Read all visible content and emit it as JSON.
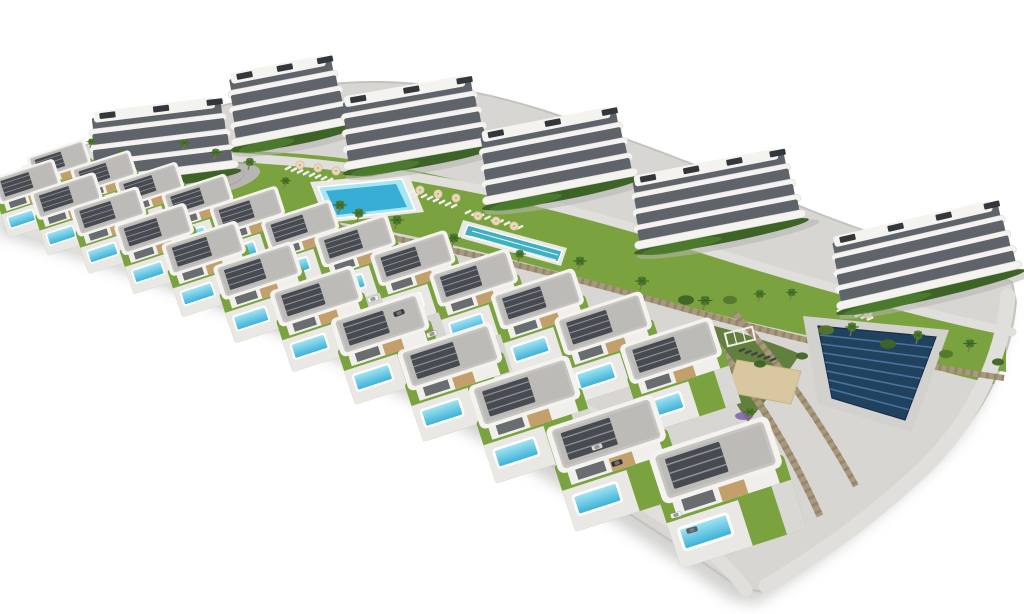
{
  "meta": {
    "type": "architectural-aerial-render",
    "aria_label": "Aerial 3D rendering of a hillside residential development: six white apartment buildings with wavy balconies at the back, two communal pools with sun loungers and palm trees, rows of modern villas with private turquoise pools in front, stone retaining walls, lawns with lavender, a solar panel field and a sand court on the right"
  },
  "palette": {
    "background": "#ffffff",
    "platform": "#d7d6d3",
    "platform_edge": "#c3c2bf",
    "shadow": "#a5a4a1",
    "road": "#e0dfdc",
    "road_mid": "#d0cfcc",
    "lawn": "#7aa340",
    "lawn_dark": "#55762c",
    "hedge": "#3e6327",
    "wall_stone": "#a8997d",
    "wall_stone_dark": "#85775c",
    "building_white": "#f4f3f0",
    "building_recess": "#5f646a",
    "pergola_dark": "#33373c",
    "roof_fascia": "#f4f3f0",
    "roof_gray": "#c6c5c1",
    "roof_gravel": "#bcbbb7",
    "roof_solar": "#474a50",
    "roof_solar_line": "#8e9196",
    "facade": "#f0efeb",
    "facade_wood": "#c3a06b",
    "window_dark": "#3c4147",
    "pool_light": "#a7e7f4",
    "pool_deep": "#37aed6",
    "pool_rim": "#ffffff",
    "deck": "#e9e8e4",
    "lap_pool": "#3fb0bf",
    "solar_panel": "#21425f",
    "solar_stripe": "#47749e",
    "solar_pad": "#d2d1ce",
    "sand": "#d9c7a0",
    "lavender": "#7e62ab",
    "palm_green": "#4e7c2f",
    "palm_dark": "#3c6322",
    "palm_trunk": "#8a6f4e",
    "lounger_white": "#f3f2ef",
    "lounger_dark": "#3f444a",
    "parasol": "#ead9b8",
    "car_light": "#f2f2f0",
    "plaza": "#b8b6b2"
  },
  "platform": {
    "outline": "M 6,196 C 30,168 62,150 122,134 C 200,112 262,92 332,84 C 402,77 472,88 542,110 C 622,136 722,175 822,215 C 902,246 982,268 1012,282 L 1016,302 C 1010,362 984,416 934,462 C 878,514 820,558 764,592 L 740,588 C 640,518 480,416 330,342 C 218,288 96,246 6,222 Z",
    "shadow_dx": -8,
    "shadow_dy": 12
  },
  "greens": {
    "amenity": "M 58,162 C 160,148 280,146 380,164 C 480,182 580,212 690,248 C 800,284 918,316 1006,334 L 1006,372 C 900,356 780,332 670,302 C 560,272 460,244 360,226 C 260,208 150,196 54,186 Z",
    "right": "M 836,300 C 898,318 958,330 1002,336 L 994,384 C 938,372 878,352 834,336 Z",
    "slope": "M 698,322 C 740,332 772,342 800,354 C 782,382 764,402 748,422 C 726,390 710,356 698,322 Z"
  },
  "roads": [
    {
      "name": "promenade-top",
      "d": "M 60,156 C 300,148 480,178 700,248 C 832,290 950,320 1012,332",
      "width": 9
    },
    {
      "name": "street-middle",
      "d": "M 22,204 C 250,262 480,356 640,436 C 700,466 730,488 758,512",
      "width": 11
    },
    {
      "name": "street-front",
      "d": "M 8,222 C 240,300 470,408 640,502 C 692,534 722,558 746,590",
      "width": 13
    },
    {
      "name": "road-right-edge",
      "d": "M 1008,296 C 1002,360 972,420 926,466 C 878,512 824,552 766,586",
      "width": 15
    }
  ],
  "walls": [
    {
      "d": "M 54,186 C 260,208 460,246 660,302 C 800,342 920,366 1004,378",
      "width": 6
    },
    {
      "d": "M 698,322 C 748,380 788,444 820,516",
      "width": 7
    },
    {
      "d": "M 734,312 C 782,366 822,424 856,486",
      "width": 6
    }
  ],
  "buildings": [
    {
      "x": 160,
      "y": 141,
      "w": 138,
      "floors": 4,
      "rot": -7
    },
    {
      "x": 286,
      "y": 100,
      "w": 112,
      "floors": 4,
      "rot": -11
    },
    {
      "x": 412,
      "y": 122,
      "w": 138,
      "floors": 4,
      "rot": -10
    },
    {
      "x": 554,
      "y": 155,
      "w": 146,
      "floors": 4,
      "rot": -11
    },
    {
      "x": 714,
      "y": 198,
      "w": 162,
      "floors": 4,
      "rot": -11
    },
    {
      "x": 922,
      "y": 254,
      "w": 178,
      "floors": 4,
      "rot": -13
    }
  ],
  "villas": {
    "rows": [
      {
        "name": "villa-row-back",
        "positions": [
          [
            62,
            170,
            0.72
          ],
          [
            107,
            182,
            0.75
          ],
          [
            153,
            195,
            0.78
          ],
          [
            201,
            208,
            0.81
          ],
          [
            251,
            222,
            0.85
          ],
          [
            304,
            237,
            0.88
          ],
          [
            359,
            253,
            0.92
          ],
          [
            417,
            271,
            0.96
          ],
          [
            478,
            291,
            1.0
          ],
          [
            542,
            313,
            1.05
          ],
          [
            608,
            338,
            1.1
          ],
          [
            676,
            366,
            1.15
          ]
        ]
      },
      {
        "name": "villa-row-front",
        "positions": [
          [
            30,
            192,
            0.78
          ],
          [
            70,
            207,
            0.82
          ],
          [
            112,
            223,
            0.86
          ],
          [
            158,
            241,
            0.9
          ],
          [
            208,
            261,
            0.95
          ],
          [
            262,
            284,
            1.0
          ],
          [
            321,
            310,
            1.05
          ],
          [
            385,
            339,
            1.11
          ],
          [
            455,
            372,
            1.18
          ],
          [
            530,
            409,
            1.26
          ],
          [
            612,
            452,
            1.35
          ],
          [
            722,
            480,
            1.5
          ]
        ]
      }
    ]
  },
  "pools": {
    "main": {
      "deck": "310,182 408,173 424,212 326,223",
      "water": "318,187 402,179 415,210 331,219",
      "core": "326,191 396,184 407,207 337,215"
    },
    "lap": {
      "deck": "463,220 567,248 561,266 457,237",
      "water": "468,225 562,251 558,262 464,235",
      "lanes": [
        {
          "x1": 472,
          "y1": 231,
          "x2": 558,
          "y2": 255
        },
        {
          "x1": 470,
          "y1": 236,
          "x2": 556,
          "y2": 260
        }
      ]
    }
  },
  "features": {
    "playground": {
      "cx": 215,
      "cy": 180,
      "rx": 46,
      "ry": 14,
      "rot": -12,
      "dots": [
        [
          200,
          176,
          "#cf9a3c"
        ],
        [
          214,
          183,
          "#5a87c5"
        ],
        [
          228,
          178,
          "#c96b4a"
        ],
        [
          220,
          174,
          "#7aa340"
        ]
      ]
    },
    "sand_court": {
      "points": "737,360 801,371 791,404 727,392"
    },
    "solar": {
      "pad": "803,316 949,330 912,432 818,404",
      "panels": "818,326 936,337 905,420 832,398",
      "stripes": 7
    },
    "pergola": {
      "x": 726,
      "y": 330,
      "w": 28,
      "h": 13,
      "rot": -14
    },
    "clubhouse": {
      "x": 52,
      "y": 172,
      "rot": -15
    }
  },
  "loungers": [
    {
      "x": 288,
      "y": 168,
      "n": 8,
      "dx": 6,
      "dy": 1.7,
      "rot": -28,
      "dark": false
    },
    {
      "x": 412,
      "y": 192,
      "n": 8,
      "dx": 6,
      "dy": 2.0,
      "rot": -28,
      "dark": false
    },
    {
      "x": 468,
      "y": 212,
      "n": 9,
      "dx": 6.5,
      "dy": 1.9,
      "rot": -26,
      "dark": false
    },
    {
      "x": 840,
      "y": 310,
      "n": 6,
      "dx": 6,
      "dy": 1.7,
      "rot": -24,
      "dark": false
    },
    {
      "x": 742,
      "y": 350,
      "n": 6,
      "dx": 6.2,
      "dy": 1.9,
      "rot": -22,
      "dark": true
    }
  ],
  "parasols": [
    [
      300,
      165
    ],
    [
      318,
      168
    ],
    [
      336,
      171
    ],
    [
      420,
      190
    ],
    [
      438,
      194
    ],
    [
      456,
      198
    ],
    [
      478,
      216
    ],
    [
      496,
      221
    ],
    [
      514,
      226
    ],
    [
      852,
      310
    ],
    [
      868,
      314
    ]
  ],
  "palms": [
    [
      183,
      150,
      0.8
    ],
    [
      214,
      160,
      0.85
    ],
    [
      248,
      170,
      0.9
    ],
    [
      338,
      214,
      1
    ],
    [
      357,
      222,
      1
    ],
    [
      395,
      229,
      1
    ],
    [
      452,
      247,
      1
    ],
    [
      518,
      262,
      0.9
    ],
    [
      578,
      270,
      1
    ],
    [
      640,
      290,
      1
    ],
    [
      703,
      310,
      1.05
    ],
    [
      758,
      302,
      0.9
    ],
    [
      850,
      336,
      1
    ],
    [
      916,
      344,
      1
    ],
    [
      968,
      352,
      0.95
    ],
    [
      120,
      160,
      0.75
    ],
    [
      90,
      148,
      0.7
    ],
    [
      284,
      188,
      0.8
    ],
    [
      748,
      420,
      0.9
    ],
    [
      790,
      300,
      0.85
    ]
  ],
  "lavender_patches": [
    [
      96,
      180,
      7
    ],
    [
      162,
      198,
      8
    ],
    [
      238,
      216,
      7
    ],
    [
      310,
      238,
      8
    ],
    [
      392,
      258,
      8
    ],
    [
      470,
      280,
      8
    ],
    [
      552,
      300,
      9
    ],
    [
      628,
      322,
      9
    ],
    [
      694,
      348,
      8
    ],
    [
      716,
      382,
      8
    ],
    [
      744,
      416,
      9
    ],
    [
      766,
      448,
      8
    ],
    [
      620,
      440,
      7
    ],
    [
      540,
      392,
      7
    ],
    [
      136,
      250,
      6
    ],
    [
      208,
      276,
      6
    ]
  ],
  "bushes": [
    [
      70,
      190,
      6
    ],
    [
      132,
      202,
      7
    ],
    [
      196,
      216,
      6
    ],
    [
      258,
      230,
      7
    ],
    [
      322,
      246,
      7
    ],
    [
      384,
      260,
      6
    ],
    [
      448,
      276,
      7
    ],
    [
      512,
      292,
      7
    ],
    [
      576,
      308,
      7
    ],
    [
      640,
      326,
      7
    ],
    [
      702,
      344,
      7
    ],
    [
      760,
      364,
      6
    ],
    [
      826,
      330,
      8
    ],
    [
      888,
      344,
      8
    ],
    [
      946,
      354,
      7
    ],
    [
      998,
      362,
      6
    ],
    [
      58,
      168,
      5
    ],
    [
      686,
      300,
      8
    ],
    [
      730,
      300,
      7
    ],
    [
      802,
      356,
      6
    ]
  ],
  "cars": [
    [
      373,
      299,
      -20,
      "#f2f2f0"
    ],
    [
      399,
      313,
      -20,
      "#3a3f45"
    ],
    [
      432,
      334,
      -20,
      "#e8e7e4"
    ],
    [
      597,
      447,
      -18,
      "#d9d8d5"
    ],
    [
      617,
      463,
      -18,
      "#2f343a"
    ],
    [
      676,
      515,
      -15,
      "#f0efec"
    ],
    [
      692,
      530,
      -15,
      "#585d63"
    ]
  ]
}
